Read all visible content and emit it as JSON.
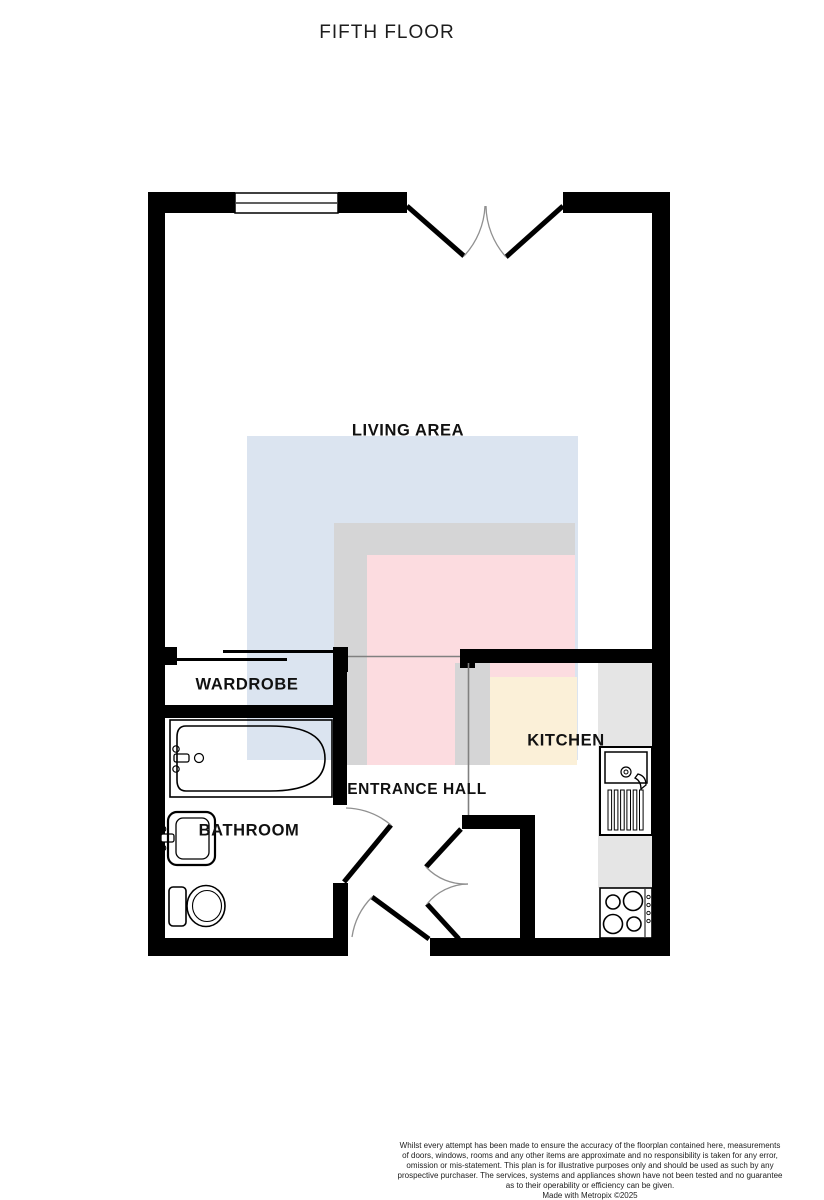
{
  "page": {
    "title": "FIFTH FLOOR"
  },
  "rooms": {
    "living_area": {
      "label": "LIVING AREA"
    },
    "wardrobe": {
      "label": "WARDROBE"
    },
    "kitchen": {
      "label": "KITCHEN"
    },
    "entrance_hall": {
      "label": "ENTRANCE HALL"
    },
    "bathroom": {
      "label": "BATHROOM"
    }
  },
  "fixtures": [
    "window-icon",
    "french-doors-icon",
    "wardrobe-sliding-doors-icon",
    "bathtub-icon",
    "basin-icon",
    "toilet-icon",
    "kitchen-sink-icon",
    "hob-icon",
    "door-swing-icon"
  ],
  "colors": {
    "wall": "#000000",
    "zone_blue": "#dbe4f0",
    "zone_gray": "#d5d5d6",
    "zone_pink": "#fcdce0",
    "zone_yellow": "#fbf0d8",
    "counter_gray": "#e5e5e5",
    "thin_line": "#808080"
  },
  "footer": {
    "line1": "Whilst every attempt has been made to ensure the accuracy of the floorplan contained here, measurements",
    "line2": "of doors, windows, rooms and any other items are approximate and no responsibility is taken for any error,",
    "line3": "omission or mis-statement. This plan is for illustrative purposes only and should be used as such by any",
    "line4": "prospective purchaser. The services, systems and appliances shown have not been tested and no guarantee",
    "line5": "as to their operability or efficiency can be given.",
    "line6": "Made with Metropix ©2025"
  }
}
